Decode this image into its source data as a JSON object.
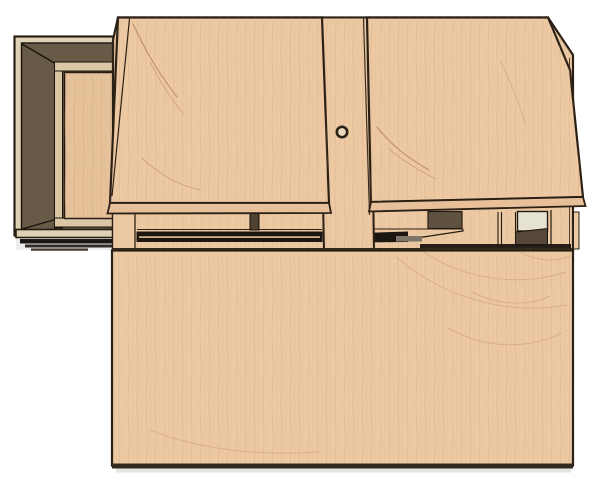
{
  "scene": {
    "type": "3d-render",
    "description": "CAD-style rendering of a light maple plywood assembly viewed from the front: a cabinet body with two outward-tilted plywood lids, a center divider strip with a small round finger hole, a slotted front rail, a large flat front panel below, and a dark-walled open compartment with an inset plywood panel attached on the left.",
    "background": "#ffffff"
  },
  "objects": [
    {
      "name": "left-compartment",
      "description": "open box seen in perspective with dark brown interior walls, pale outer rim and an inset light plywood panel, stacked thin base layers beneath"
    },
    {
      "name": "cabinet-body",
      "description": "light plywood carcass with angled top corners"
    },
    {
      "name": "left-lid",
      "description": "tilted plywood lid panel with visible bottom edge band and grain cracks"
    },
    {
      "name": "right-lid",
      "description": "tilted plywood lid panel, right edge slanting outward, visible bottom edge band"
    },
    {
      "name": "center-divider",
      "description": "vertical plywood strip between the lids"
    },
    {
      "name": "finger-hole",
      "description": "small round hole in the center divider"
    },
    {
      "name": "front-rail",
      "description": "horizontal rail with dark slots, recesses and a pale inset square"
    },
    {
      "name": "front-panel",
      "description": "large flat plywood front panel with swirling grain, dark bottom edge"
    }
  ],
  "palette": {
    "background": "#ffffff",
    "wood": "#ecc9a3",
    "wood_shade": "#e7c09a",
    "rim": "#ded1b4",
    "strip": "#d9c7a6",
    "panel": "#e6c29b",
    "dark_wall": "#675a46",
    "recess": "#5f5240",
    "recess_dark": "#564838",
    "black": "#1b1610",
    "outline": "#2b2015",
    "pale_square": "#e7e3d3",
    "hole": "#ead9bd",
    "grain": "#c89a72",
    "crack": "#b08259",
    "grey_bar": "#7d7668",
    "edge_dark": "#332a1e",
    "band_line": "#c9b28c",
    "slot": "#4e4131"
  }
}
